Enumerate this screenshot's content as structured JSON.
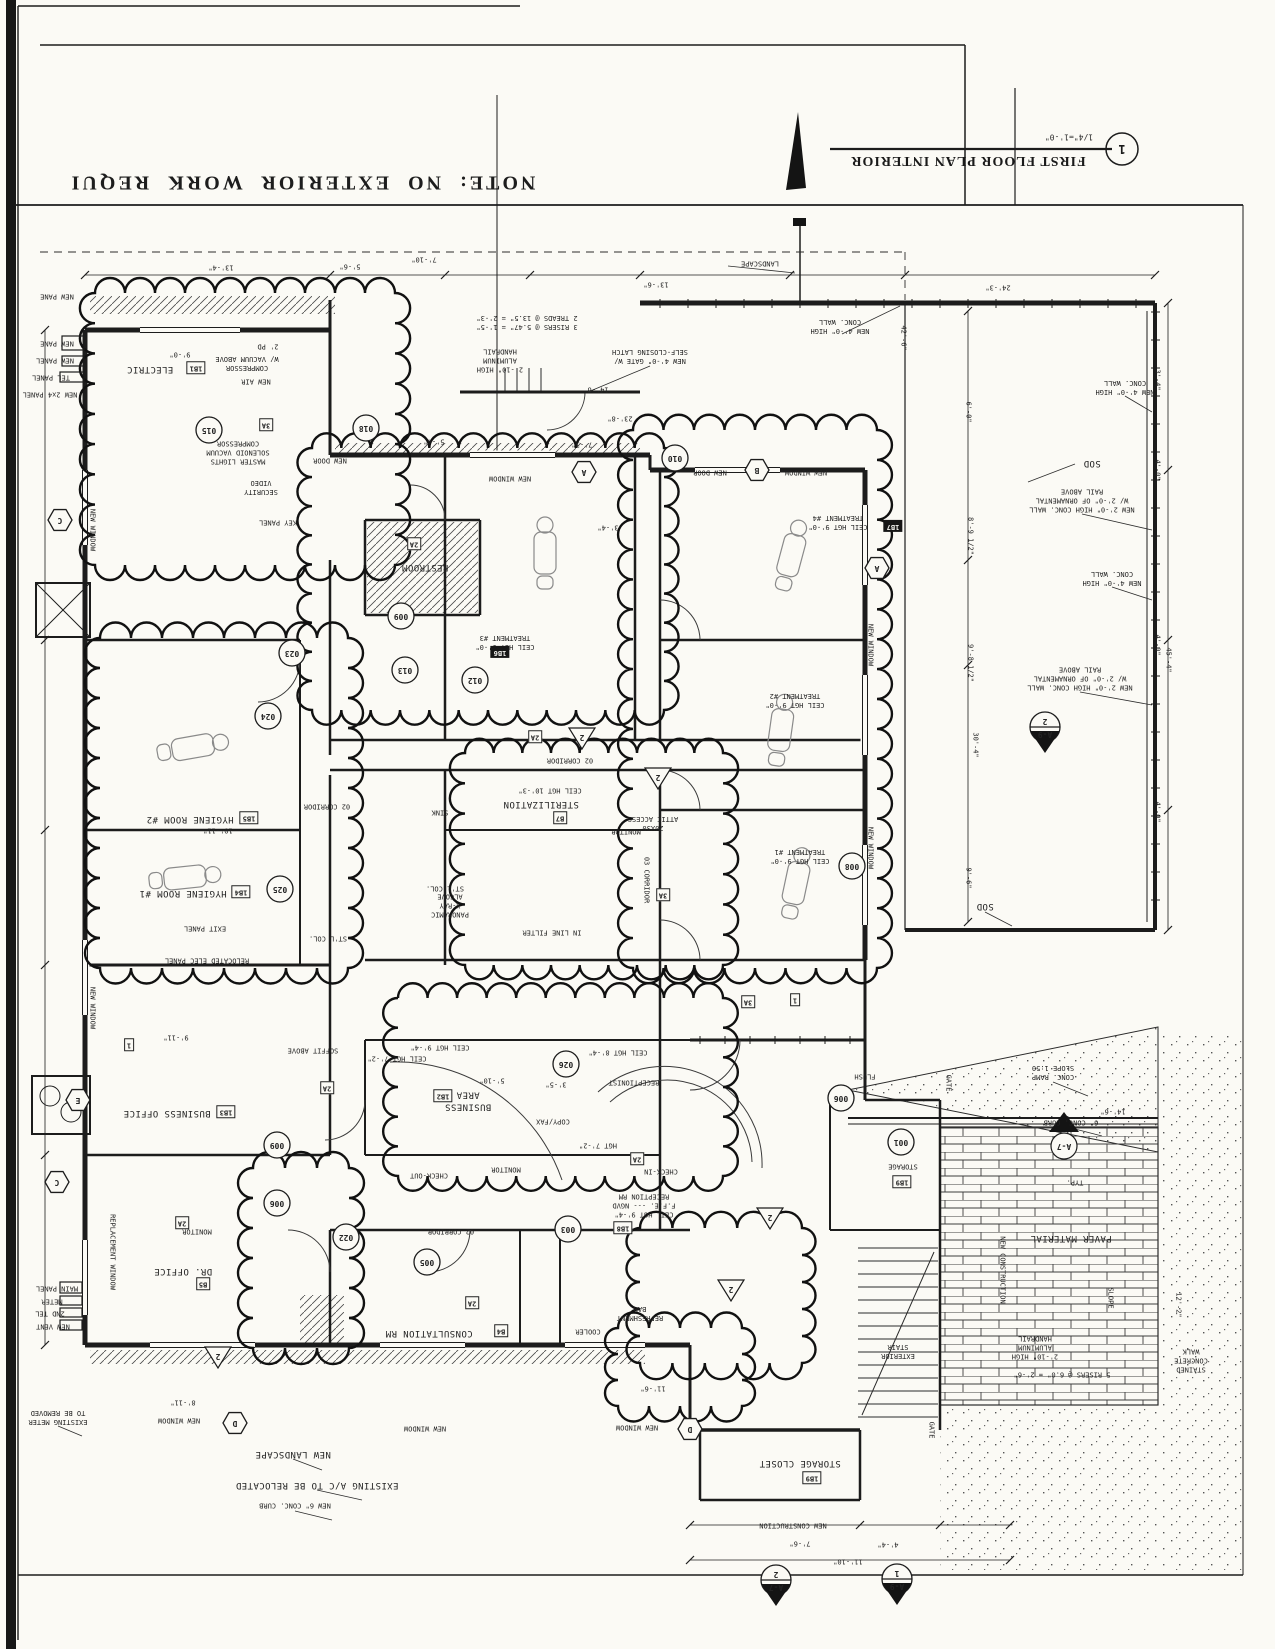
{
  "sheet": {
    "note_text": "NOTE:  NO  EXTERIOR  WORK  REQUI",
    "drawing_title": "FIRST FLOOR PLAN INTERIOR",
    "drawing_scale": "1/4\"=1'-0\"",
    "detail_number": "1"
  },
  "labels": [
    "LANDSCAPE",
    "13'-6\"",
    "7'-10\"",
    "5'-6\"",
    "13'-4\"",
    "24'-3\"",
    "NEW 4'-0\" HIGH\nCONC. WALL",
    "NEW 4'-0\" HIGH\nCONC. WALL",
    "SOD",
    "NEW 2'-0\" HIGH CONC. WALL\nW/ 2'-0\" OF ORNAMENTAL\nRAIL ABOVE",
    "NEW 4'-0\" HIGH\nCONC. WALL",
    "NEW 2'-0\" HIGH CONC. WALL\nW/ 2'-0\" OF ORNAMENTAL\nRAIL ABOVE",
    "SOD",
    "42'-6\"",
    "6'-0\"",
    "8'-9 1/2\"",
    "9'-8 1/2\"",
    "30'-4\"",
    "45'-4\"",
    "3'-4\"",
    "4'-0\"",
    "4'-0\"",
    "4'-0\"",
    "9'-6\"",
    "NEW PANE",
    "NEW PANE",
    "NEW PANEL",
    "TEL PANEL",
    "NEW 2x4 PANEL",
    "ELECTRIC",
    "9'-0\"",
    "COMPRESSOR\nW/ VACUUM ABOVE",
    "2' PD",
    "NEW AIR",
    "MASTER LIGHTS\nSOLENOID VACUUM\nCOMPRESSOR",
    "SECURITY\nVIDEO",
    "KEY PANEL",
    "NEW DOOR",
    "NEW WINDOW",
    "NEW DOOR",
    "NEW WINDOW",
    "2'-10\" HIGH\nALUMINUM\nHANDRAIL",
    "NEW 4'-0\" GATE W/\nSELF-CLOSING LATCH",
    "3 RISERS @ 5.47\" = 1'-5\"\n2 TREADS @ 13.5\" = 2'-3\"",
    "14'-6\"",
    "23'-8\"",
    "7'-3\"",
    "5'-4\"",
    "3'-4\"",
    "CEIL HGT 9'-0\"\nTREATMENT #4",
    "CEIL HGT 9'-0\"\nTREATMENT #3",
    "CEIL HGT 9'-0\"\nTREATMENT #2",
    "CEIL HGT 9'-0\"\nTREATMENT #1",
    "02 CORRIDOR",
    "CEIL HGT 10'-3\"",
    "STERILIZATION",
    "SINK",
    "20X30\nATTIC ACCESS",
    "MONITOR",
    "03 CORRIDOR",
    "ST'L COL.",
    "ST'L COL.",
    "PANORAMIC\nX-RAY\nALCOVE",
    "IN LINE FILTER",
    "RESTROOM",
    "HYGIENE ROOM #2",
    "10'-11\"",
    "HYGIENE ROOM #1",
    "02 CORRIDOR",
    "RELOCATED ELEC PANEL",
    "EXIT PANEL",
    "NEW WINDOW",
    "NEW WINDOW",
    "NEW WINDOW",
    "NEW WINDOW",
    "SOFFIT ABOVE",
    "9'-11\"",
    "BUSINESS OFFICE",
    "DR. OFFICE",
    "REPLACEMENT WINDOW",
    "CEIL HGT 9'-4\"",
    "CEIL HGT 7'-2\"",
    "CEIL HGT 8'-4\"",
    "RECEPTIONIST",
    "BUSINESS\nAREA",
    "5'-10\"",
    "3'-5\"",
    "COPY/FAX",
    "HGT 7'-2\"",
    "CHECK-IN",
    "CHECK-OUT",
    "MONITOR",
    "CEIL HGT 9'-4\"\nF.F.E. --- NGVD\nRECEPTION RM",
    "02 CORRIDOR",
    "CONSULTATION RM",
    "REFRESHMENT\nBAR",
    "COOLER",
    "MONITOR",
    "STORAGE",
    "FLUSH",
    "GATE",
    "GATE",
    "CONC. RAMP\nSLOPE 1:50",
    "6\" CONC. CURB",
    "TYP.",
    "PAVER MATERIAL",
    "SLOPE",
    "NEW CONSTRUCTION",
    "EXTERIOR\nSTAIR",
    "2'-10\" HIGH\nALUMINUM\nHANDRAIL",
    "5 RISERS @ 6.0\" = 2'-6\"",
    "STAINED\nCONCRETE\nWALK",
    "12'-2\"",
    "14'-6\"",
    "STORAGE CLOSET",
    "NEW CONSTRUCTION",
    "7'-6\"",
    "4'-4\"",
    "11'-10\"",
    "11'-6\"",
    "NEW WINDOW",
    "NEW WINDOW",
    "NEW WINDOW",
    "NEW LANDSCAPE",
    "EXISTING A/C TO BE RELOCATED",
    "NEW 6\" CONC. CURB",
    "EXISTING METER\nTO BE REMOVED",
    "MAIN PANEL",
    "METER",
    "2ND TEL",
    "NEW VENT",
    "8'-11\"",
    "015",
    "018",
    "010",
    "024",
    "025",
    "023",
    "013",
    "012",
    "009",
    "026",
    "003",
    "005",
    "009",
    "006",
    "022",
    "001",
    "006",
    "008",
    "2",
    "2",
    "2",
    "2",
    "2",
    "A",
    "A",
    "B",
    "C",
    "C",
    "D",
    "D",
    "E",
    "3A",
    "3A",
    "2A",
    "2A",
    "2A",
    "2A",
    "2A",
    "2A",
    "3A",
    "1",
    "1",
    "1B1",
    "1B2",
    "1B3",
    "1B4",
    "1B5",
    "1B8",
    "1B9",
    "1B9",
    "B5",
    "B4",
    "B7",
    "1B7",
    "1B6",
    "2",
    "A-9",
    "2",
    "A-7",
    "1",
    "A-9",
    "A-7"
  ]
}
